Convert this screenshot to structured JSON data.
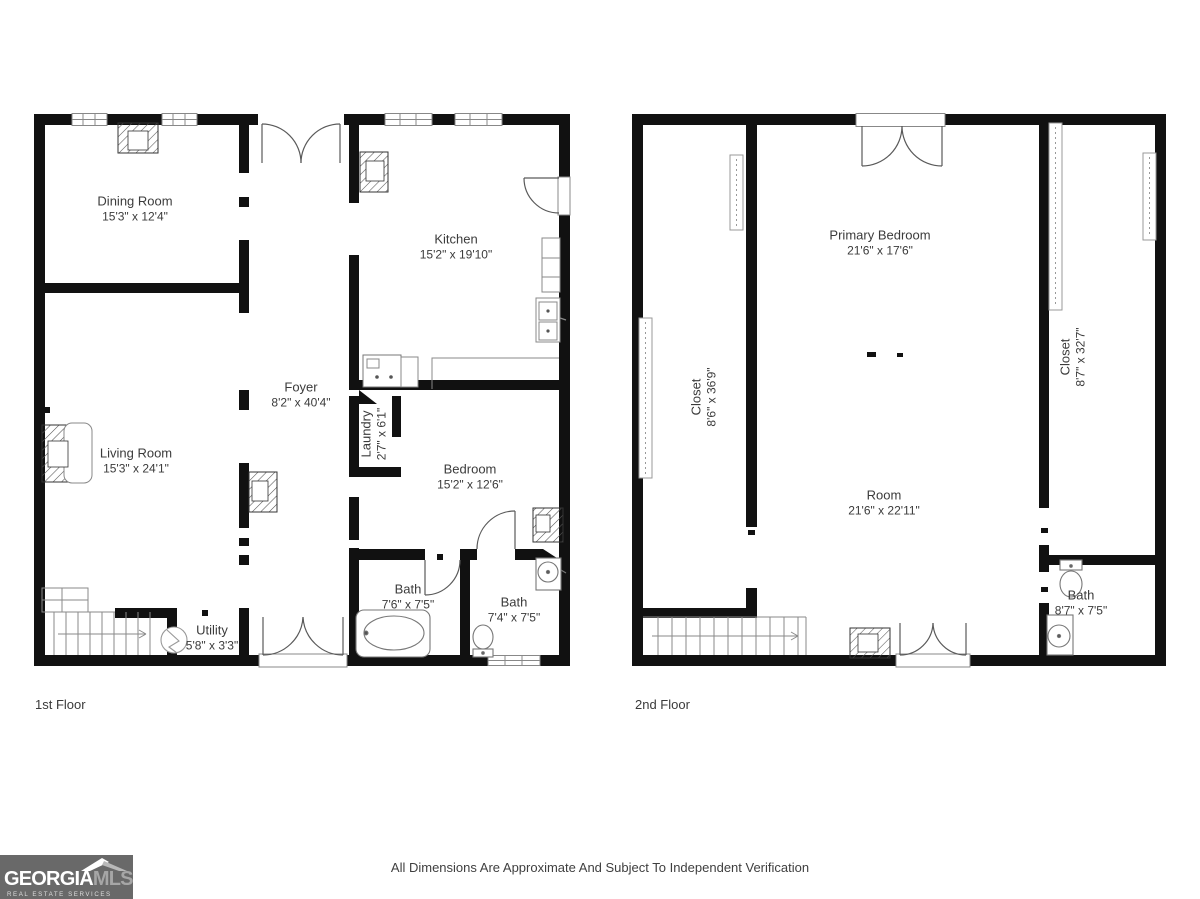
{
  "disclaimer": "All Dimensions Are Approximate And Subject To Independent Verification",
  "logo": {
    "brand_primary": "GEORGIA",
    "brand_secondary": "MLS",
    "tagline": "REAL ESTATE SERVICES"
  },
  "floors": [
    {
      "label": "1st Floor",
      "rooms": [
        {
          "name": "Dining Room",
          "dims": "15'3\" x 12'4\""
        },
        {
          "name": "Kitchen",
          "dims": "15'2\" x 19'10\""
        },
        {
          "name": "Foyer",
          "dims": "8'2\" x 40'4\""
        },
        {
          "name": "Laundry",
          "dims": "2'7\" x 6'1\""
        },
        {
          "name": "Living Room",
          "dims": "15'3\" x 24'1\""
        },
        {
          "name": "Bedroom",
          "dims": "15'2\" x 12'6\""
        },
        {
          "name": "Bath",
          "dims": "7'6\" x 7'5\""
        },
        {
          "name": "Bath",
          "dims": "7'4\" x 7'5\""
        },
        {
          "name": "Utility",
          "dims": "5'8\" x 3'3\""
        }
      ]
    },
    {
      "label": "2nd Floor",
      "rooms": [
        {
          "name": "Primary Bedroom",
          "dims": "21'6\" x 17'6\""
        },
        {
          "name": "Closet",
          "dims": "8'6\" x 36'9\""
        },
        {
          "name": "Closet",
          "dims": "8'7\" x 32'7\""
        },
        {
          "name": "Room",
          "dims": "21'6\" x 22'11\""
        },
        {
          "name": "Bath",
          "dims": "8'7\" x 7'5\""
        }
      ]
    }
  ],
  "colors": {
    "wall": "#111111",
    "fixture": "#8a8a8a",
    "label": "#3b3b3b",
    "logo_bg": "#696969"
  }
}
